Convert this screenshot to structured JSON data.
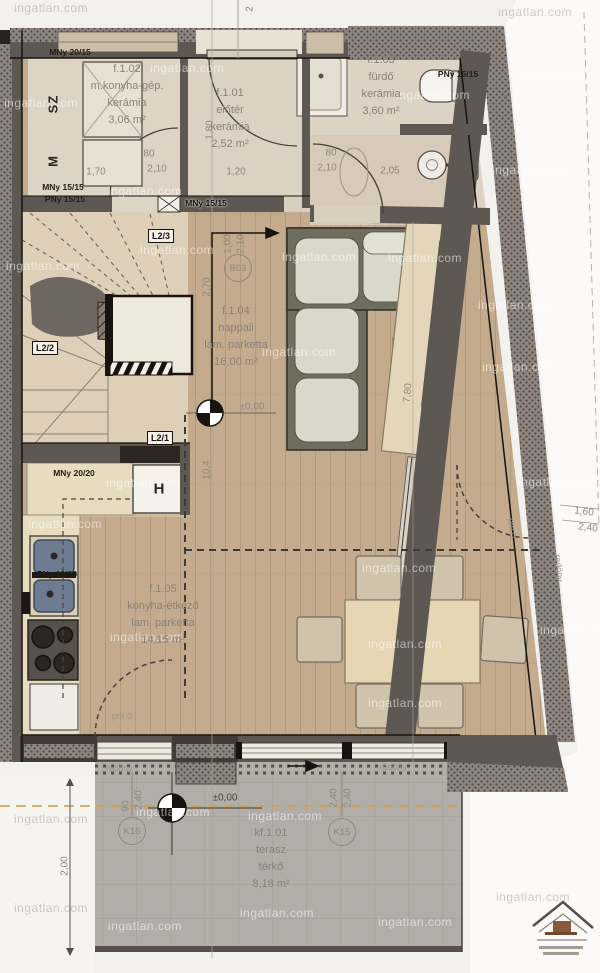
{
  "watermark": {
    "text": "ingatlan.com",
    "instances": [
      {
        "x": 14,
        "y": 8,
        "v": "d"
      },
      {
        "x": 498,
        "y": 12,
        "v": "d"
      },
      {
        "x": 150,
        "y": 68,
        "v": "l"
      },
      {
        "x": 4,
        "y": 103,
        "v": "l"
      },
      {
        "x": 516,
        "y": 75,
        "v": "l"
      },
      {
        "x": 396,
        "y": 95,
        "v": "l"
      },
      {
        "x": 108,
        "y": 191,
        "v": "l"
      },
      {
        "x": 492,
        "y": 170,
        "v": "l"
      },
      {
        "x": 6,
        "y": 266,
        "v": "l"
      },
      {
        "x": 140,
        "y": 250,
        "v": "l"
      },
      {
        "x": 282,
        "y": 257,
        "v": "l"
      },
      {
        "x": 388,
        "y": 258,
        "v": "l"
      },
      {
        "x": 262,
        "y": 352,
        "v": "l"
      },
      {
        "x": 478,
        "y": 305,
        "v": "l"
      },
      {
        "x": 482,
        "y": 367,
        "v": "l"
      },
      {
        "x": 28,
        "y": 524,
        "v": "l"
      },
      {
        "x": 106,
        "y": 483,
        "v": "l"
      },
      {
        "x": 110,
        "y": 637,
        "v": "l"
      },
      {
        "x": 362,
        "y": 568,
        "v": "l"
      },
      {
        "x": 368,
        "y": 644,
        "v": "l"
      },
      {
        "x": 368,
        "y": 703,
        "v": "l"
      },
      {
        "x": 136,
        "y": 812,
        "v": "l"
      },
      {
        "x": 248,
        "y": 816,
        "v": "l"
      },
      {
        "x": 14,
        "y": 819,
        "v": "d"
      },
      {
        "x": 518,
        "y": 482,
        "v": "l"
      },
      {
        "x": 108,
        "y": 926,
        "v": "l"
      },
      {
        "x": 240,
        "y": 913,
        "v": "l"
      },
      {
        "x": 378,
        "y": 922,
        "v": "l"
      },
      {
        "x": 496,
        "y": 897,
        "v": "d"
      },
      {
        "x": 14,
        "y": 908,
        "v": "d"
      },
      {
        "x": 540,
        "y": 630,
        "v": "l"
      }
    ]
  },
  "rooms": {
    "f102": {
      "id": "f.1.02",
      "name": "m.konyha-gép.",
      "floor": "kerámia",
      "area": "3,06 m²"
    },
    "f101": {
      "id": "f.1.01",
      "name": "előtér",
      "floor": "kerámia",
      "area": "2,52 m²"
    },
    "f103": {
      "id": "f.1.03",
      "name": "fürdő",
      "floor": "kerámia",
      "area": "3,60 m²"
    },
    "f104": {
      "id": "f.1.04",
      "name": "nappali",
      "floor": "lam. parketta",
      "area": "16,00 m²"
    },
    "f105": {
      "id": "f.1.05",
      "name": "konyha-étkező",
      "floor": "lam. parketta",
      "area": "14,15 m²"
    },
    "kf101": {
      "id": "kf.1.01",
      "name": "terasz",
      "floor": "térkő",
      "area": "8,18 m²"
    }
  },
  "markers": {
    "b03": "B03",
    "k15": "K15",
    "k16": "K16",
    "l21": "L2/1",
    "l22": "L2/2",
    "l23": "L2/3"
  },
  "labels": [
    {
      "t": "MNy 20/15",
      "x": 70,
      "y": 52,
      "c": "wl",
      "n": "window-label"
    },
    {
      "t": "MNy 15/15",
      "x": 63,
      "y": 187,
      "c": "wl",
      "n": "window-label"
    },
    {
      "t": "PNy 15/15",
      "x": 65,
      "y": 199,
      "c": "wl",
      "n": "window-label"
    },
    {
      "t": "MNy 15/15",
      "x": 206,
      "y": 203,
      "c": "wld",
      "n": "window-label"
    },
    {
      "t": "PNy 15/15",
      "x": 458,
      "y": 74,
      "c": "wl",
      "n": "window-label"
    },
    {
      "t": "MNy 20/20",
      "x": 74,
      "y": 473,
      "c": "wl",
      "n": "window-label"
    },
    {
      "t": "PNy 10/10",
      "x": 57,
      "y": 574,
      "c": "wl",
      "n": "window-label"
    },
    {
      "t": "1,70",
      "x": 96,
      "y": 172,
      "c": "dim",
      "n": "dim-label"
    },
    {
      "t": "80",
      "x": 149,
      "y": 154,
      "c": "dim",
      "n": "door-width-label"
    },
    {
      "t": "2,10",
      "x": 157,
      "y": 169,
      "c": "dim",
      "n": "door-height-label"
    },
    {
      "t": "1,20",
      "x": 236,
      "y": 172,
      "c": "dim",
      "n": "dim-label"
    },
    {
      "t": "1,80",
      "x": 210,
      "y": 130,
      "r": -90,
      "c": "dim",
      "n": "dim-label"
    },
    {
      "t": "80",
      "x": 331,
      "y": 153,
      "c": "dim",
      "n": "door-width-label"
    },
    {
      "t": "2,10",
      "x": 327,
      "y": 168,
      "c": "dim",
      "n": "door-height-label"
    },
    {
      "t": "2,05",
      "x": 390,
      "y": 171,
      "c": "dim",
      "n": "dim-label"
    },
    {
      "t": "1,00",
      "x": 228,
      "y": 244,
      "r": -90,
      "c": "dim",
      "n": "dim-label"
    },
    {
      "t": "2,10",
      "x": 241,
      "y": 244,
      "r": -90,
      "c": "dim",
      "n": "dim-label"
    },
    {
      "t": "2,70",
      "x": 207,
      "y": 287,
      "r": -90,
      "c": "dim",
      "n": "dim-label"
    },
    {
      "t": "7,80",
      "x": 408,
      "y": 393,
      "r": -84,
      "c": "dim",
      "n": "dim-label"
    },
    {
      "t": "10,4",
      "x": 207,
      "y": 470,
      "r": -90,
      "c": "dim",
      "n": "dim-label"
    },
    {
      "t": "2",
      "x": 250,
      "y": 9,
      "r": -90,
      "c": "dim",
      "n": "dim-label"
    },
    {
      "t": "1,60",
      "x": 584,
      "y": 512,
      "r": 7,
      "c": "dim",
      "n": "dim-label"
    },
    {
      "t": "2,40",
      "x": 588,
      "y": 528,
      "r": 7,
      "c": "dim",
      "n": "dim-label"
    },
    {
      "t": "90",
      "x": 126,
      "y": 806,
      "r": -90,
      "c": "dim",
      "n": "dim-label"
    },
    {
      "t": "2,40",
      "x": 139,
      "y": 800,
      "r": -90,
      "c": "dim",
      "n": "dim-label"
    },
    {
      "t": "2,40",
      "x": 334,
      "y": 798,
      "r": -90,
      "c": "dim",
      "n": "dim-label"
    },
    {
      "t": "2,40",
      "x": 348,
      "y": 798,
      "r": -90,
      "c": "dim",
      "n": "dim-label"
    },
    {
      "t": "2,00",
      "x": 65,
      "y": 866,
      "r": -90,
      "c": "dim",
      "n": "dim-label"
    },
    {
      "t": "±0,00",
      "x": 252,
      "y": 407,
      "c": "dim",
      "n": "elevation-label"
    },
    {
      "t": "±0,00",
      "x": 225,
      "y": 798,
      "c": "elev",
      "n": "elevation-label"
    },
    {
      "t": "pm 0",
      "x": 122,
      "y": 716,
      "c": "sub",
      "n": "parapet-label"
    },
    {
      "t": "pm 0",
      "x": 512,
      "y": 528,
      "r": 83,
      "c": "sub",
      "n": "parapet-label"
    },
    {
      "t": "redőny",
      "x": 119,
      "y": 768,
      "c": "sub",
      "n": "shutter-label"
    },
    {
      "t": "redőny",
      "x": 393,
      "y": 767,
      "c": "sub",
      "n": "shutter-label"
    },
    {
      "t": "redőny",
      "x": 559,
      "y": 568,
      "r": 84,
      "c": "sub",
      "n": "shutter-label"
    },
    {
      "t": "SZ",
      "x": 53,
      "y": 104,
      "r": -90,
      "c": "appl",
      "n": "dryer-label"
    },
    {
      "t": "M",
      "x": 53,
      "y": 161,
      "r": -90,
      "c": "appl",
      "n": "washer-label"
    },
    {
      "t": "H",
      "x": 159,
      "y": 489,
      "c": "applbig",
      "n": "fridge-label"
    }
  ]
}
